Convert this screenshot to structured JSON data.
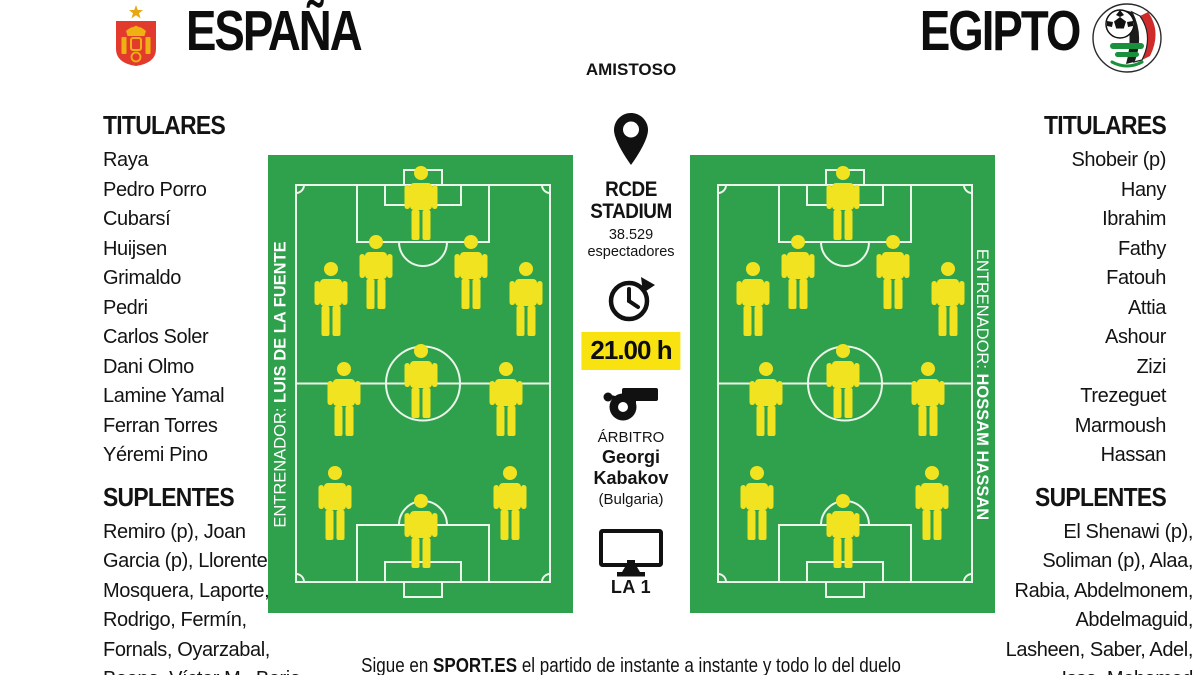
{
  "match": {
    "type_label": "AMISTOSO",
    "home": {
      "name": "ESPAÑA",
      "coach_label": "ENTRENADOR: ",
      "coach_name": "LUIS DE LA FUENTE",
      "titulares_label": "TITULARES",
      "suplentes_label": "SUPLENTES",
      "titulares": [
        "Raya",
        "Pedro Porro",
        "Cubarsí",
        "Huijsen",
        "Grimaldo",
        "Pedri",
        "Carlos Soler",
        "Dani Olmo",
        "Lamine Yamal",
        "Ferran Torres",
        "Yéremi Pino"
      ],
      "suplentes_lines": [
        "Remiro (p), Joan",
        "Garcia (p), Llorente,",
        "Mosquera, Laporte,",
        "Rodrigo, Fermín,",
        "Fornals, Oyarzabal,",
        "Baena, Víctor M., Borja"
      ]
    },
    "away": {
      "name": "EGIPTO",
      "coach_label": "ENTRENADOR: ",
      "coach_name": "HOSSAM HASSAN",
      "titulares_label": "TITULARES",
      "suplentes_label": "SUPLENTES",
      "titulares": [
        "Shobeir (p)",
        "Hany",
        "Ibrahim",
        "Fathy",
        "Fatouh",
        "Attia",
        "Ashour",
        "Zizi",
        "Trezeguet",
        "Marmoush",
        "Hassan"
      ],
      "suplentes_lines": [
        "El Shenawi (p),",
        "Soliman (p), Alaa,",
        "Rabia, Abdelmonem,",
        "Abdelmaguid,",
        "Lasheen, Saber, Adel,",
        "Issa, Mohamed"
      ]
    },
    "venue": {
      "name_line1": "RCDE",
      "name_line2": "STADIUM",
      "attendance": "38.529",
      "attendance_label": "espectadores"
    },
    "kickoff_time": "21.00 h",
    "referee": {
      "label": "ÁRBITRO",
      "first_name": "Georgi",
      "last_name": "Kabakov",
      "country": "(Bulgaria)"
    },
    "tv_channel": "LA 1",
    "footer": {
      "prefix": "Sigue en ",
      "brand": "SPORT.ES",
      "rest": " el partido de instante a instante y todo lo del duelo"
    }
  },
  "formation": {
    "home": "4-3-3",
    "away": "4-3-3",
    "positions": [
      [
        50,
        2.3
      ],
      [
        35.5,
        17.5
      ],
      [
        66.5,
        17.5
      ],
      [
        20.5,
        23.3
      ],
      [
        84.5,
        23.3
      ],
      [
        50,
        41.3
      ],
      [
        25,
        45.3
      ],
      [
        78,
        45.3
      ],
      [
        22,
        68
      ],
      [
        79.5,
        68
      ],
      [
        50,
        74
      ]
    ]
  },
  "icons": {
    "home_crest": "spain-federation-crest",
    "away_crest": "egypt-federation-crest",
    "venue": "location-pin-icon",
    "time": "clock-icon",
    "referee": "whistle-icon",
    "tv": "tv-icon"
  },
  "colors": {
    "pitch_green": "#2fa04c",
    "player_yellow": "#f2e320",
    "time_highlight": "#f8e311",
    "crest_red": "#e23b2e",
    "line_white": "#ecf5ea",
    "text_black": "#111111"
  }
}
